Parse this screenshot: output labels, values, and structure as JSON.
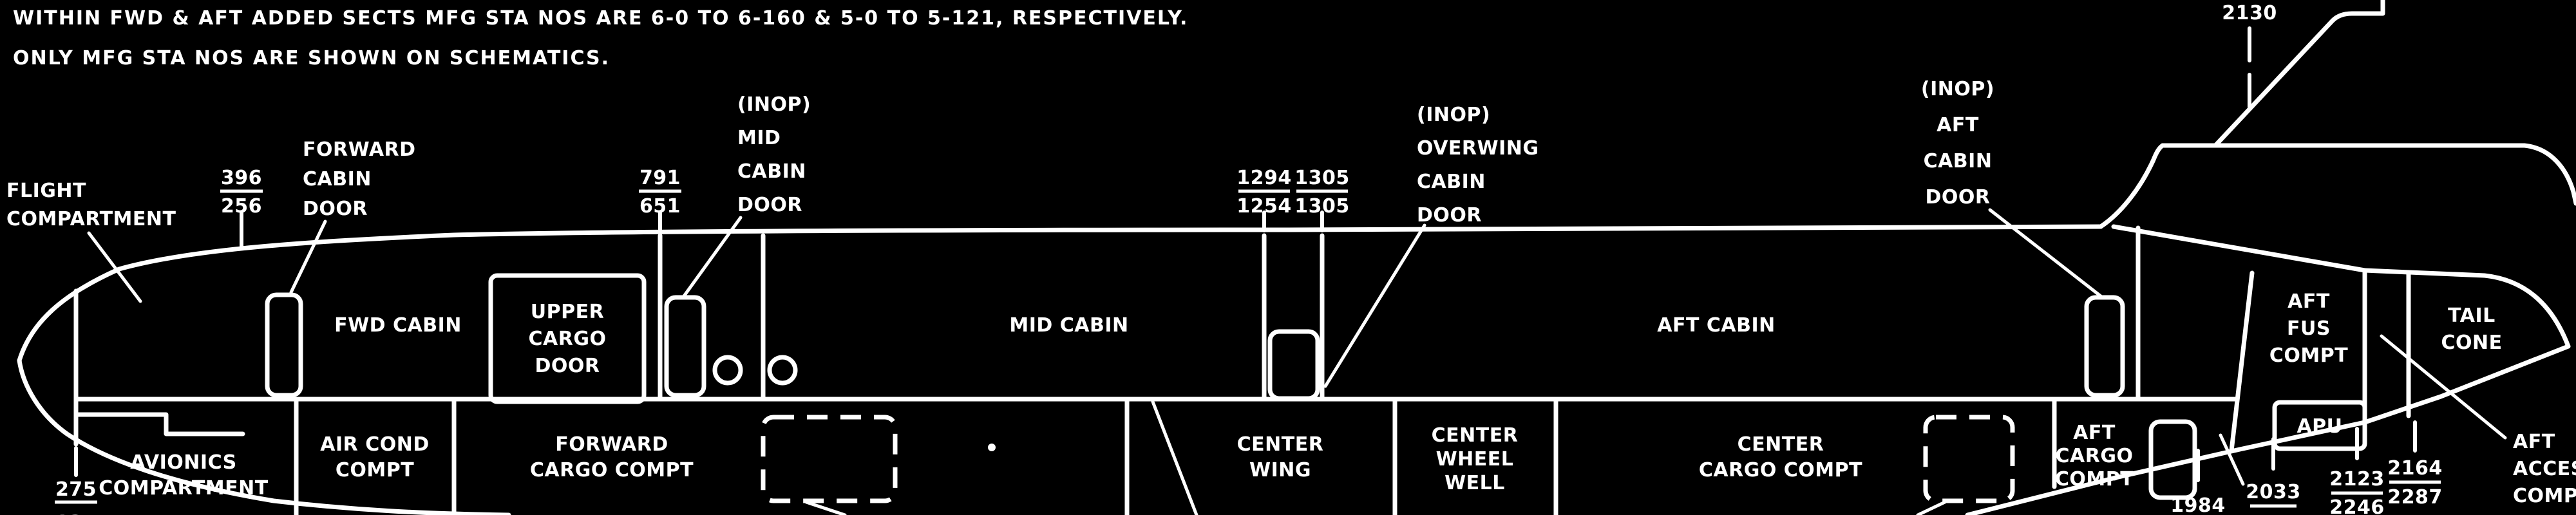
{
  "colors": {
    "background": "#000000",
    "foreground": "#ffffff"
  },
  "notes": [
    "WITHIN FWD & AFT ADDED SECTS MFG STA NOS ARE 6-0 TO 6-160 & 5-0 TO 5-121, RESPECTIVELY.",
    "ONLY MFG STA NOS ARE SHOWN ON SCHEMATICS."
  ],
  "stations": {
    "sta275": {
      "top": "275",
      "bottom": "135"
    },
    "sta396": {
      "top": "396",
      "bottom": "256"
    },
    "sta791": {
      "top": "791",
      "bottom": "651"
    },
    "sta1294": {
      "top": "1294",
      "bottom": "1254"
    },
    "sta1305": {
      "top": "1305",
      "bottom": "1305"
    },
    "sta2130": {
      "top": "2130"
    },
    "sta1984": {
      "top": "1984"
    },
    "sta2033": {
      "top": "2033"
    },
    "sta2123": {
      "top": "2123",
      "bottom": "2246"
    },
    "sta2164": {
      "top": "2164",
      "bottom": "2287"
    }
  },
  "labels": {
    "flight_compartment": [
      "FLIGHT",
      "COMPARTMENT"
    ],
    "forward_cabin_door": [
      "FORWARD",
      "CABIN",
      "DOOR"
    ],
    "mid_cabin_door": [
      "(INOP)",
      "MID",
      "CABIN",
      "DOOR"
    ],
    "overwing_cabin_door": [
      "(INOP)",
      "OVERWING",
      "CABIN",
      "DOOR"
    ],
    "aft_cabin_door": [
      "(INOP)",
      "AFT",
      "CABIN",
      "DOOR"
    ],
    "upper_cargo_door": [
      "UPPER",
      "CARGO",
      "DOOR"
    ],
    "avionics_compartment": [
      "AVIONICS",
      "COMPARTMENT"
    ],
    "fwd_cabin": "FWD CABIN",
    "mid_cabin": "MID CABIN",
    "aft_cabin": "AFT CABIN",
    "air_cond_compt": [
      "AIR COND",
      "COMPT"
    ],
    "forward_cargo_compt": [
      "FORWARD",
      "CARGO COMPT"
    ],
    "center_wing": [
      "CENTER",
      "WING"
    ],
    "center_wheel_well": [
      "CENTER",
      "WHEEL",
      "WELL"
    ],
    "center_cargo_compt": [
      "CENTER",
      "CARGO COMPT"
    ],
    "aft_cargo_compt": [
      "AFT",
      "CARGO",
      "COMPT"
    ],
    "aft_fus_compt": [
      "AFT",
      "FUS",
      "COMPT"
    ],
    "apu": "APU",
    "tail_cone": [
      "TAIL",
      "CONE"
    ],
    "aft_access_compartment": [
      "AFT",
      "ACCESS",
      "COMPARTMENT"
    ]
  }
}
